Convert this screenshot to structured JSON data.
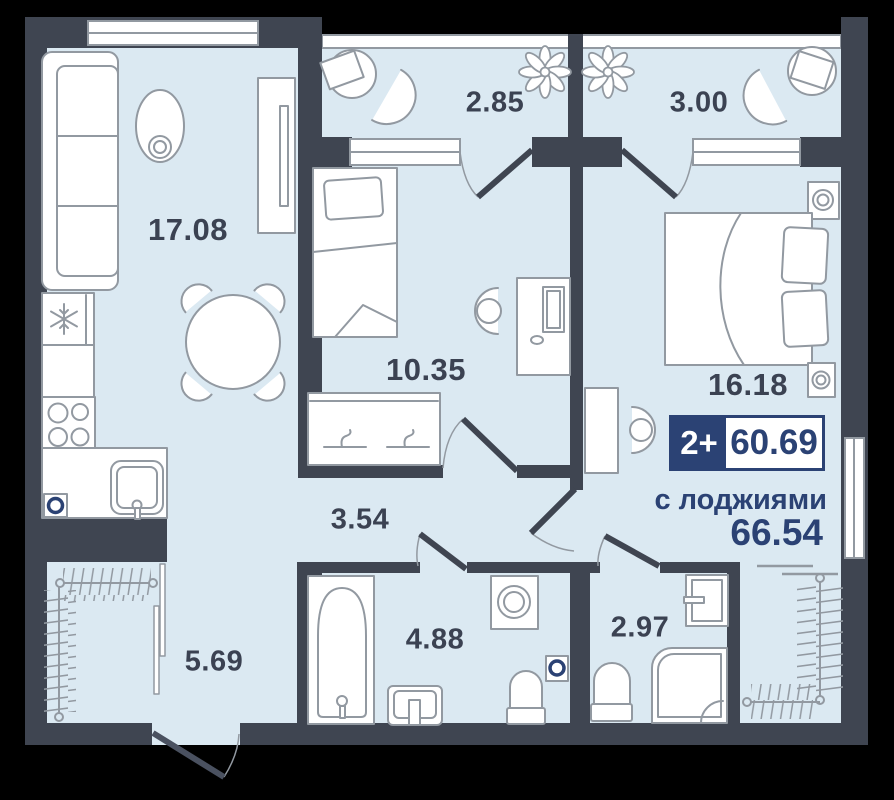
{
  "plan": {
    "badge": {
      "type_label": "2+",
      "area_total": "60.69"
    },
    "note": {
      "with_loggias_label": "с лоджиями",
      "area_with_loggias": "66.54"
    },
    "rooms": [
      {
        "name": "living-kitchen",
        "area": "17.08"
      },
      {
        "name": "balcony-left",
        "area": "2.85"
      },
      {
        "name": "balcony-right",
        "area": "3.00"
      },
      {
        "name": "bedroom-small",
        "area": "10.35"
      },
      {
        "name": "bedroom-master",
        "area": "16.18"
      },
      {
        "name": "hallway",
        "area": "3.54"
      },
      {
        "name": "loggia",
        "area": "5.69"
      },
      {
        "name": "bathroom",
        "area": "4.88"
      },
      {
        "name": "wc-shower",
        "area": "2.97"
      }
    ],
    "colors": {
      "background": "#000000",
      "wall": "#3f4551",
      "floor": "#dbe9f2",
      "outline": "#9299a1",
      "accent": "#2b4274",
      "label": "#3b4252"
    }
  }
}
